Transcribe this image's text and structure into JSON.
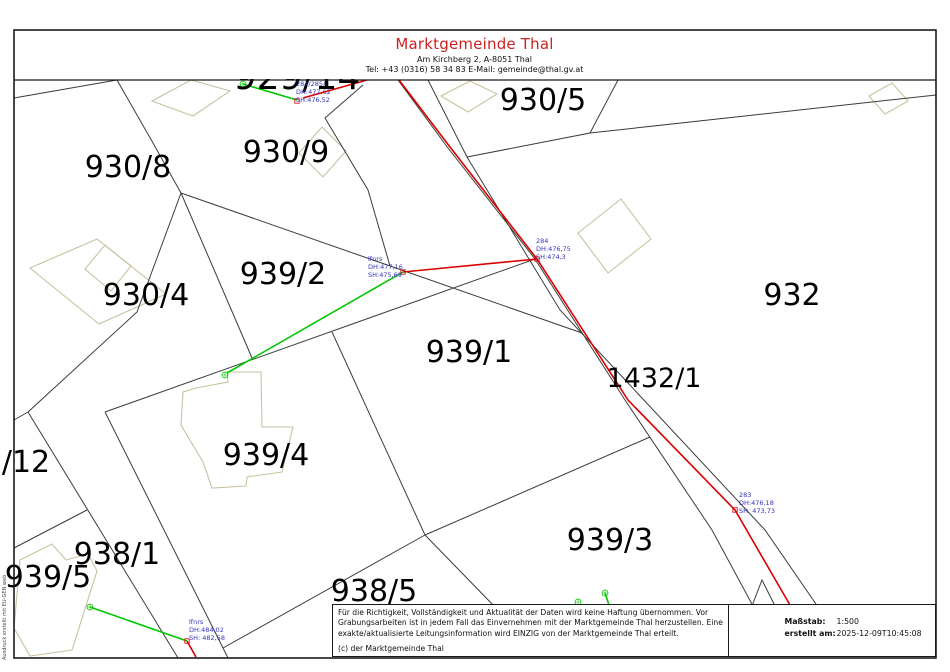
{
  "header": {
    "title": "Marktgemeinde Thal",
    "address": "Am Kirchberg 2, A-8051 Thal",
    "contact": "Tel: +43 (0316) 58 34 83 E-Mail: gemeinde@thal.gv.at"
  },
  "footer": {
    "disclaimer": "Für die Richtigkeit, Vollständigkeit und Aktualität der Daten wird keine Haftung übernommen. Vor Grabungsarbeiten ist in jedem Fall das Einvernehmen mit der Marktgemeinde Thal herzustellen. Eine exakte/aktualisierte Leitungsinformation wird EINZIG von der Marktgemeinde Thal erteilt.",
    "copyright": "(c) der Marktgemeinde Thal",
    "scale_label": "Maßstab:",
    "scale_value": "1:500",
    "created_label": "erstellt am:",
    "created_value": "2025-12-09T10:45:08"
  },
  "sidebar_note": "Ausdruck erstellt mit EU-GEN web",
  "colors": {
    "title_red": "#cc2222",
    "boundary": "#3c3c3c",
    "building": "#c9c2a0",
    "utility_red": "#dd0000",
    "utility_green": "#00c800",
    "point_label_blue": "#3333bb",
    "frame": "#1a1a1a"
  },
  "map": {
    "frame": {
      "x": 14,
      "y": 30,
      "w": 922,
      "h": 628,
      "header_line_y": 80
    },
    "parcel_labels": [
      {
        "text": "929/14",
        "x": 297,
        "y": 89,
        "size": 36
      },
      {
        "text": "930/8",
        "x": 128,
        "y": 177,
        "size": 30
      },
      {
        "text": "930/9",
        "x": 286,
        "y": 162,
        "size": 30
      },
      {
        "text": "930/5",
        "x": 543,
        "y": 110,
        "size": 30
      },
      {
        "text": "939/2",
        "x": 283,
        "y": 284,
        "size": 30
      },
      {
        "text": "930/4",
        "x": 146,
        "y": 305,
        "size": 30
      },
      {
        "text": "932",
        "x": 792,
        "y": 305,
        "size": 30
      },
      {
        "text": "939/1",
        "x": 469,
        "y": 362,
        "size": 30
      },
      {
        "text": "1432/1",
        "x": 654,
        "y": 387,
        "size": 27
      },
      {
        "text": "939/4",
        "x": 266,
        "y": 465,
        "size": 30
      },
      {
        "text": "/12",
        "x": 26,
        "y": 472,
        "size": 30
      },
      {
        "text": "938/1",
        "x": 117,
        "y": 564,
        "size": 30
      },
      {
        "text": "939/5",
        "x": 48,
        "y": 587,
        "size": 30
      },
      {
        "text": "938/5",
        "x": 374,
        "y": 601,
        "size": 30
      },
      {
        "text": "939/3",
        "x": 610,
        "y": 550,
        "size": 30
      }
    ],
    "point_labels": [
      {
        "lines": [
          "284/285/",
          "DH:477,62",
          "SH:476,52"
        ],
        "x": 296,
        "y": 86
      },
      {
        "lines": [
          "lfnrs",
          "DH:477,16",
          "SH:475,69"
        ],
        "x": 368,
        "y": 261
      },
      {
        "lines": [
          "284",
          "DH:476,75",
          "SH:474,3"
        ],
        "x": 536,
        "y": 243
      },
      {
        "lines": [
          "283",
          "DH:476,18",
          "SH: 473,73"
        ],
        "x": 739,
        "y": 497
      },
      {
        "lines": [
          "lfnrs",
          "DH:484,02",
          "SH: 482,58"
        ],
        "x": 189,
        "y": 624
      }
    ],
    "boundaries": [
      [
        117,
        80,
        153,
        143,
        181,
        193
      ],
      [
        181,
        193,
        137,
        312,
        28,
        412
      ],
      [
        28,
        412,
        14,
        420
      ],
      [
        28,
        412,
        100,
        530,
        178,
        658
      ],
      [
        181,
        193,
        240,
        330,
        252,
        358
      ],
      [
        181,
        193,
        582,
        333
      ],
      [
        105,
        412,
        535,
        259
      ],
      [
        105,
        412,
        223,
        648,
        228,
        658
      ],
      [
        332,
        332,
        425,
        535
      ],
      [
        425,
        535,
        223,
        648
      ],
      [
        425,
        535,
        495,
        607
      ],
      [
        425,
        535,
        650,
        437
      ],
      [
        398,
        80,
        448,
        148,
        535,
        259,
        625,
        400,
        712,
        530,
        753,
        606
      ],
      [
        428,
        80,
        467,
        157,
        560,
        310,
        765,
        530,
        818,
        607
      ],
      [
        618,
        80,
        590,
        133,
        467,
        157
      ],
      [
        590,
        133,
        936,
        95
      ],
      [
        14,
        98,
        117,
        80
      ],
      [
        14,
        548,
        87,
        510
      ],
      [
        752,
        606,
        762,
        580,
        775,
        606
      ],
      [
        363,
        85,
        325,
        118,
        368,
        190,
        390,
        266
      ]
    ],
    "buildings": [
      [
        30,
        268,
        97,
        239,
        166,
        294,
        99,
        324
      ],
      [
        105,
        245,
        131,
        266,
        111,
        291,
        85,
        269
      ],
      [
        152,
        101,
        191,
        80,
        230,
        91,
        193,
        116
      ],
      [
        299,
        153,
        322,
        127,
        346,
        151,
        323,
        177
      ],
      [
        578,
        233,
        621,
        199,
        651,
        239,
        608,
        273
      ],
      [
        441,
        96,
        470,
        81,
        497,
        94,
        468,
        112
      ],
      [
        869,
        96,
        892,
        83,
        908,
        101,
        885,
        114
      ],
      [
        196,
        388,
        228,
        382,
        227,
        372,
        261,
        372,
        262,
        427,
        293,
        427,
        282,
        472,
        247,
        477,
        246,
        486,
        212,
        488,
        203,
        462,
        181,
        425,
        183,
        392
      ],
      [
        20,
        560,
        52,
        544,
        66,
        560,
        88,
        554,
        97,
        571,
        72,
        650,
        30,
        656,
        14,
        628
      ]
    ],
    "red_lines": [
      [
        399,
        80,
        450,
        147,
        537,
        259,
        628,
        400,
        735,
        510,
        790,
        605
      ],
      [
        303,
        98,
        367,
        80
      ],
      [
        403,
        272,
        537,
        259
      ],
      [
        187,
        641,
        196,
        657
      ]
    ],
    "green_lines": [
      [
        243,
        84,
        297,
        100
      ],
      [
        403,
        272,
        227,
        373
      ],
      [
        90,
        607,
        187,
        641
      ],
      [
        605,
        593,
        609,
        605
      ]
    ],
    "green_circle_markers": [
      [
        243,
        84
      ],
      [
        225,
        375
      ],
      [
        90,
        607
      ],
      [
        578,
        602
      ],
      [
        605,
        593
      ]
    ],
    "red_square_markers": [
      [
        297,
        101
      ],
      [
        403,
        272
      ],
      [
        537,
        259
      ],
      [
        735,
        510
      ],
      [
        187,
        641
      ]
    ]
  }
}
